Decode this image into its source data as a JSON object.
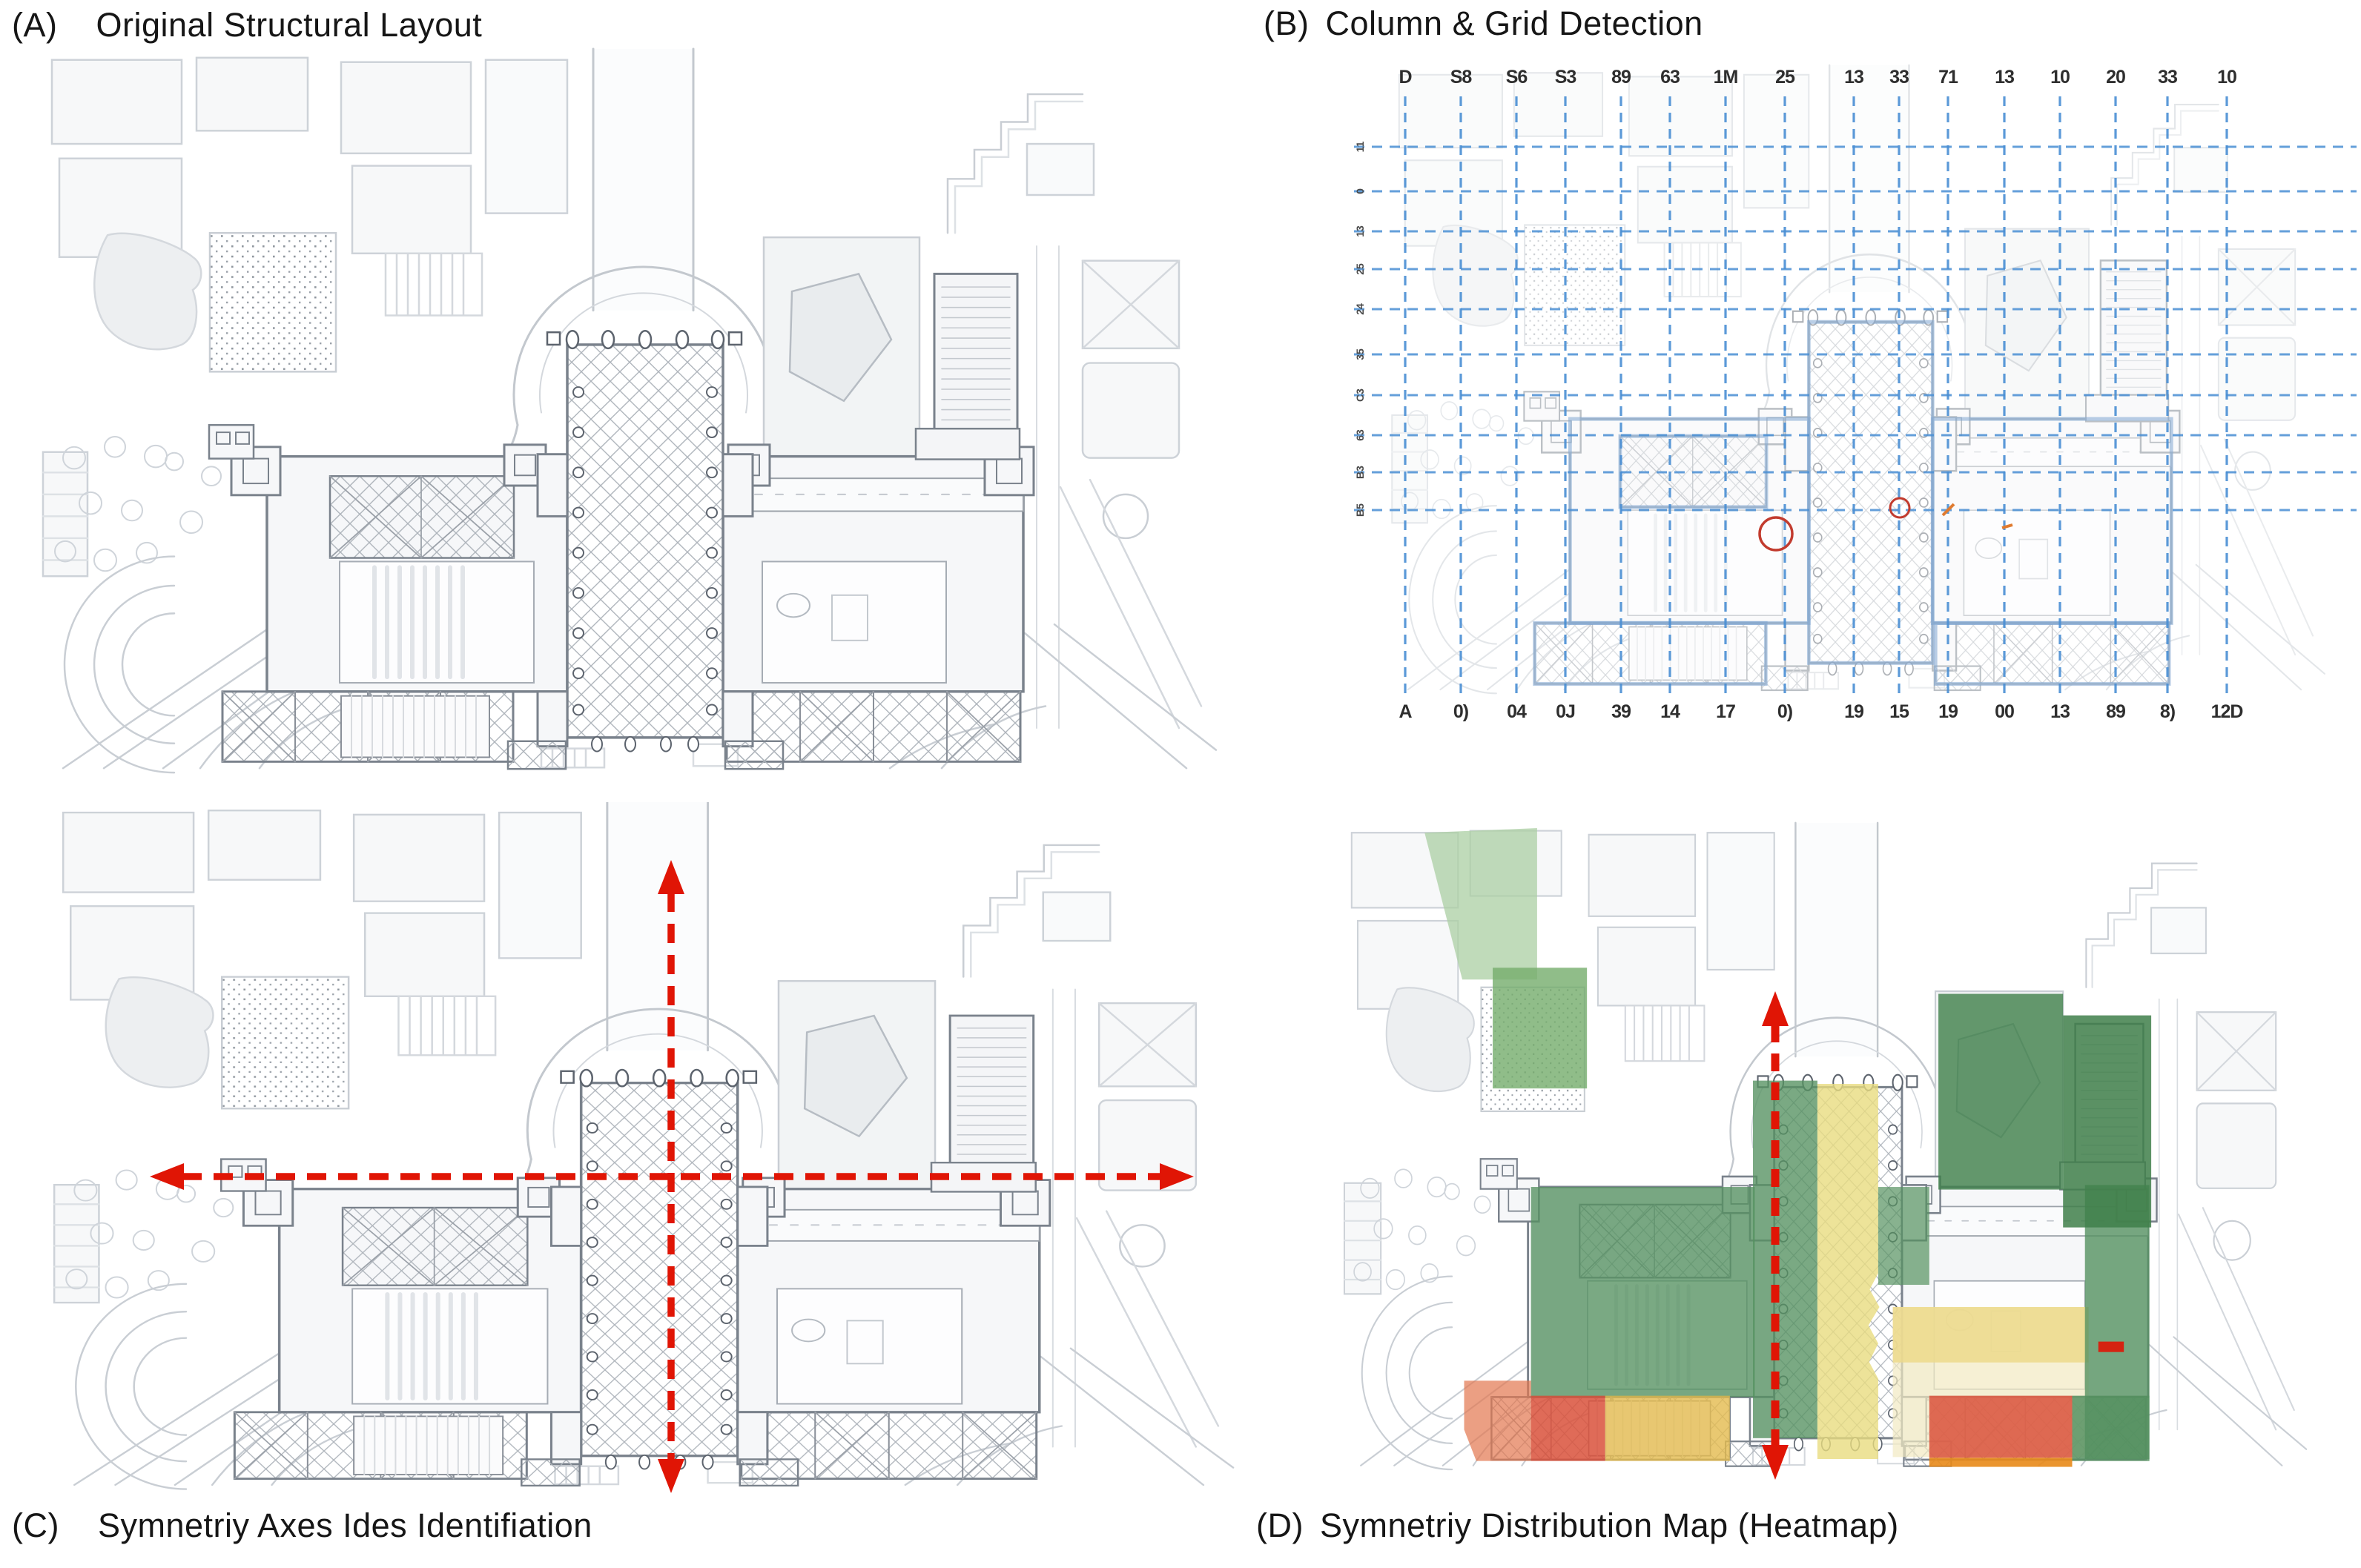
{
  "figure": {
    "panels": {
      "A": {
        "tag": "(A)",
        "title": "Original Structural Layout"
      },
      "B": {
        "tag": "(B)",
        "title": "Column & Grid Detection"
      },
      "C": {
        "tag": "(C)",
        "title": "Symnetriy Axes Ides Identifiation"
      },
      "D": {
        "tag": "(D)",
        "title": "Symnetriy Distribution Map (Heatmap)"
      }
    }
  },
  "panelB": {
    "top_labels": [
      "D",
      "S8",
      "S6",
      "S3",
      "89",
      "63",
      "1M",
      "25",
      "13",
      "33",
      "71",
      "13",
      "10",
      "20",
      "33",
      "10"
    ],
    "bottom_labels": [
      "A",
      "0)",
      "04",
      "0J",
      "39",
      "14",
      "17",
      "0)",
      "19",
      "15",
      "19",
      "00",
      "13",
      "89",
      "8)",
      "12D"
    ],
    "left_labels": [
      "11",
      "0",
      "13",
      "25",
      "24",
      "35",
      "C3",
      "63",
      "B3",
      "B5"
    ]
  },
  "colors": {
    "grid_blue": "#4a8fd4",
    "axis_red": "#e01505",
    "annotation_red": "#c23b2e",
    "annotation_orange": "#e07b30",
    "heat_green_light": "#abcfa3",
    "heat_green_mid": "#74ad6c",
    "heat_green_dark": "#559160",
    "heat_green_darker": "#3f7f4a",
    "heat_yellow": "#e9dc80",
    "heat_gold": "#e4ba4e",
    "heat_gold_pale": "#ecd98b",
    "heat_pale_yellow": "#f2eac2",
    "heat_red": "#d9513b",
    "heat_orange": "#e2764f",
    "heat_orange_bright": "#e8891a"
  },
  "heatmap_regions": [
    {
      "name": "park-north-west",
      "color": "heat_green_light"
    },
    {
      "name": "garden-speckled",
      "color": "heat_green_mid"
    },
    {
      "name": "west-wing",
      "color": "heat_green_dark"
    },
    {
      "name": "nave-west-aisle",
      "color": "heat_green_dark"
    },
    {
      "name": "nave-central-strip",
      "color": "heat_yellow"
    },
    {
      "name": "north-gallery-east",
      "color": "heat_green_dark"
    },
    {
      "name": "east-court-upper",
      "color": "heat_gold_pale"
    },
    {
      "name": "east-court-lower",
      "color": "heat_pale_yellow"
    },
    {
      "name": "east-wing-strip",
      "color": "heat_green_dark"
    },
    {
      "name": "north-east-block",
      "color": "heat_green_darker"
    },
    {
      "name": "north-east-annex",
      "color": "heat_green_darker"
    },
    {
      "name": "south-west-chapel",
      "color": "heat_red"
    },
    {
      "name": "south-west-hall",
      "color": "heat_gold"
    },
    {
      "name": "south-west-outer",
      "color": "heat_orange"
    },
    {
      "name": "south-east-chapel",
      "color": "heat_red"
    },
    {
      "name": "south-east-strip",
      "color": "heat_orange_bright"
    },
    {
      "name": "south-east-corner",
      "color": "heat_green_dark"
    }
  ]
}
